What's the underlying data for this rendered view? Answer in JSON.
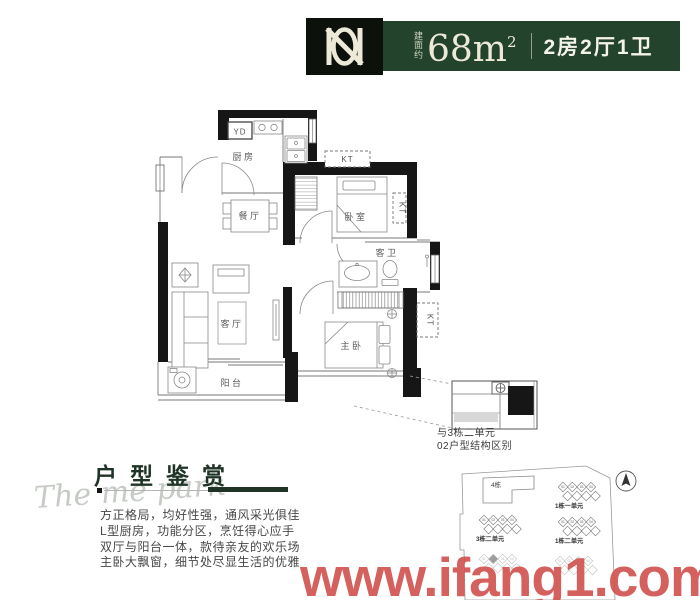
{
  "header": {
    "area_prefix": "建面约",
    "area_value": "68m",
    "area_superscript": "2",
    "layout_summary": "2房2厅1卫",
    "bar_color": "#24432c",
    "text_color": "#ece9d8"
  },
  "floorplan": {
    "rooms": {
      "kitchen": "厨房",
      "dining": "餐厅",
      "living": "客厅",
      "balcony": "阳台",
      "bedroom": "卧室",
      "bathroom": "客卫",
      "master_bedroom": "主卧"
    },
    "equipment": {
      "yd": "YD",
      "kt": "KT"
    }
  },
  "inset": {
    "caption_line1": "与3栋二单元",
    "caption_line2": "02户型结构区别"
  },
  "appreciation": {
    "script_text": "The me park",
    "title": "户型鉴赏",
    "lines": [
      "方正格局，均好性强，通风采光俱佳",
      "L型厨房，功能分区，烹饪得心应手",
      "双厅与阳台一体，款待亲友的欢乐场",
      "主卧大飘窗，细节处尽显生活的优雅"
    ]
  },
  "siteplan": {
    "building4_label": "4栋",
    "unit_numbers": [
      "01",
      "02",
      "03",
      "04"
    ],
    "clusters": [
      {
        "cx": 139,
        "cy": 25,
        "label": "1栋一单元",
        "faded": false,
        "marker": false
      },
      {
        "cx": 139,
        "cy": 60,
        "label": "1栋二单元",
        "faded": false,
        "marker": false
      },
      {
        "cx": 60,
        "cy": 58,
        "label": "3栋二单元",
        "faded": false,
        "marker": false
      },
      {
        "cx": 60,
        "cy": 97,
        "label": "",
        "faded": true,
        "marker": true
      },
      {
        "cx": 136,
        "cy": 99,
        "label": "",
        "faded": true,
        "marker": false
      }
    ]
  },
  "watermark": {
    "text": "www.ifang1.com",
    "color": "#d0514d"
  }
}
